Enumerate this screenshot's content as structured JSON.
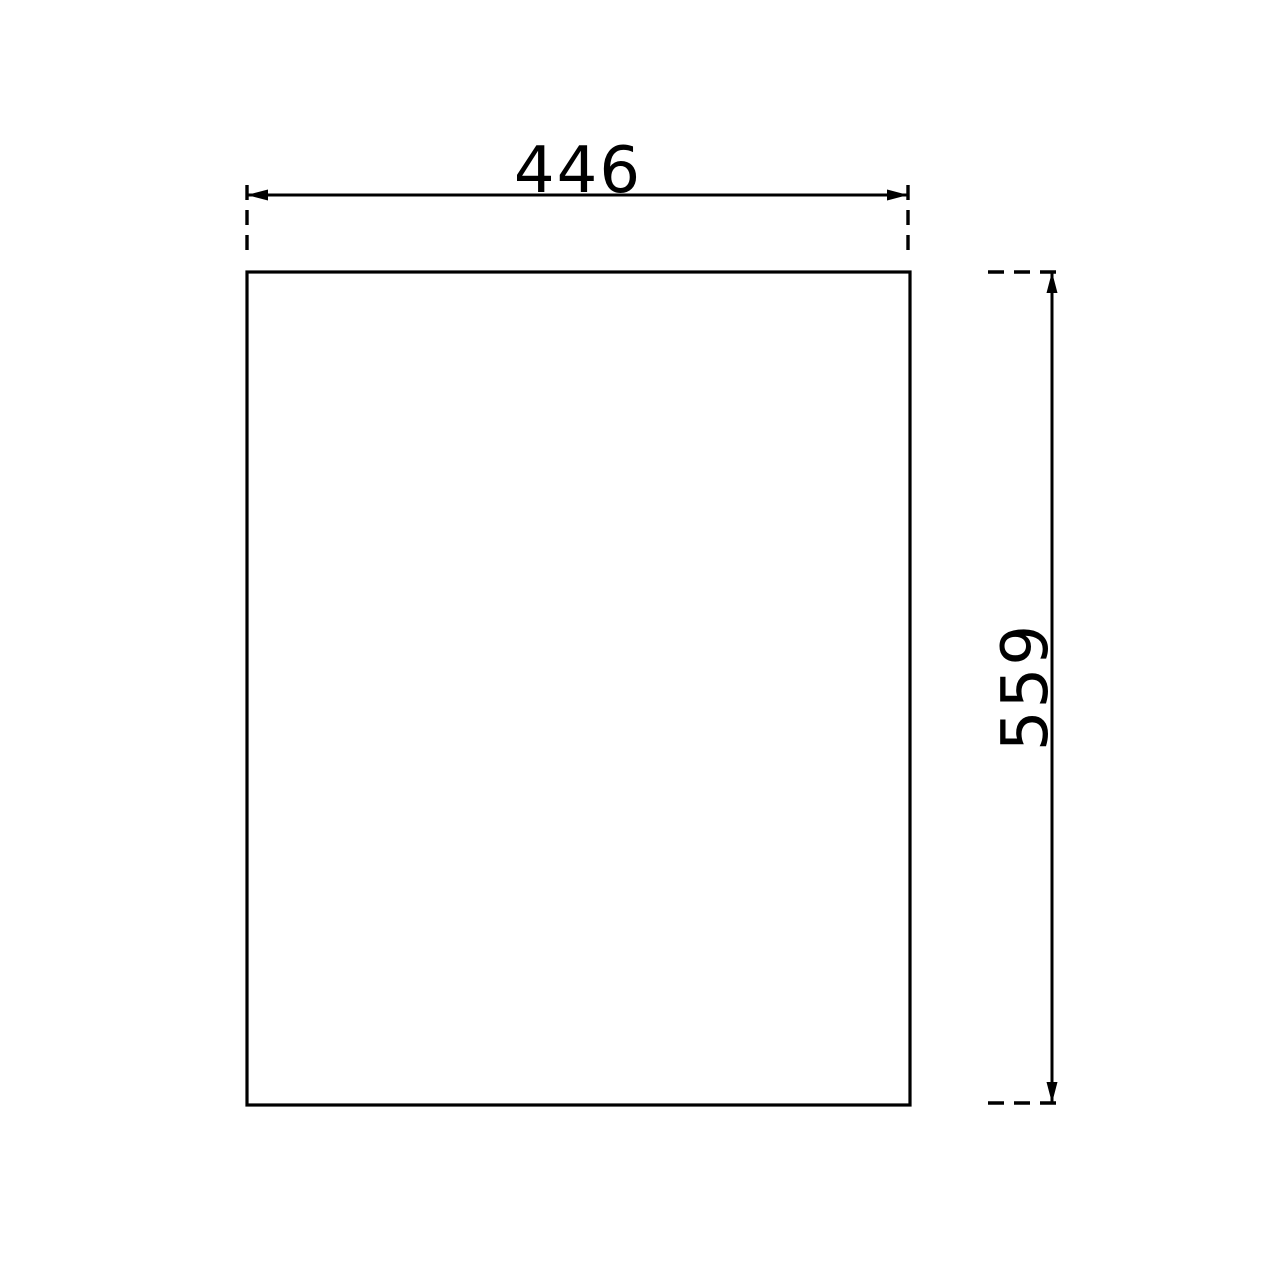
{
  "drawing": {
    "line_color": "#000000",
    "background_color": "#ffffff",
    "dimensions": {
      "width": {
        "label": "446"
      },
      "height": {
        "label": "559"
      }
    }
  }
}
